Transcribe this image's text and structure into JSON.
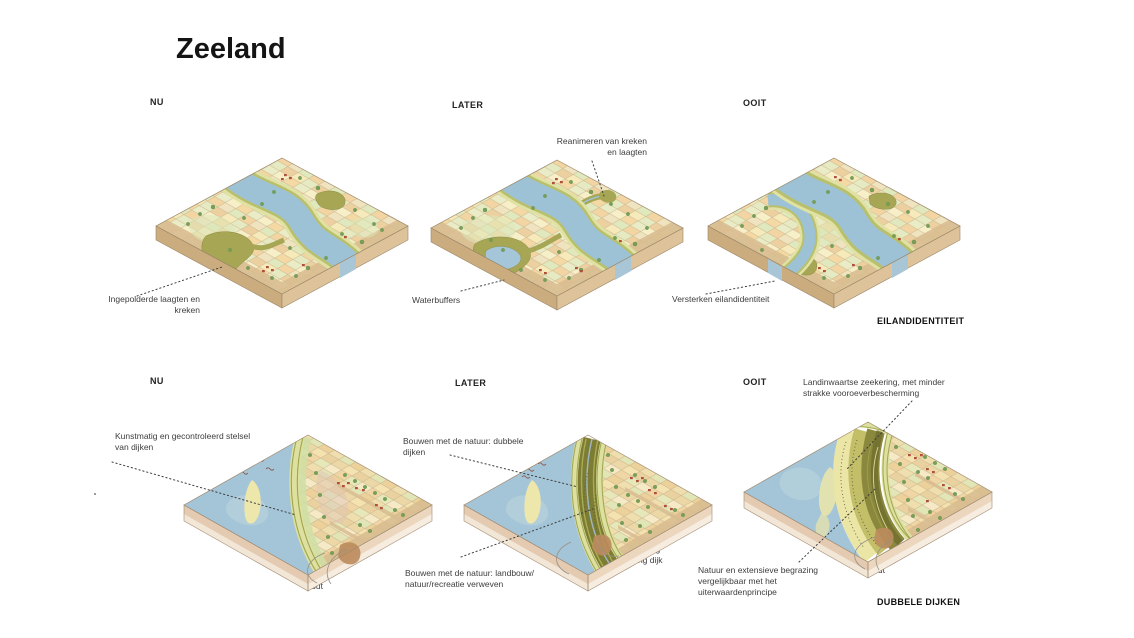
{
  "page": {
    "title": "Zeeland"
  },
  "row1": {
    "nu": "NU",
    "later": "LATER",
    "ooit": "OOIT",
    "category": "EILANDIDENTITEIT",
    "reanimeren_line1": "Reanimeren van kreken",
    "reanimeren_line2": "en laagten",
    "ingepolderde_line1": "Ingepolderde laagten en",
    "ingepolderde_line2": "kreken",
    "waterbuffers": "Waterbuffers",
    "versterken": "Versterken eilandidentiteit"
  },
  "row2": {
    "nu": "NU",
    "later": "LATER",
    "ooit": "OOIT",
    "category": "DUBBELE DIJKEN",
    "landinwaartse_line1": "Landinwaartse zeekering, met minder",
    "landinwaartse_line2": "strakke vooroeverbescherming",
    "kunstmatig_line1": "Kunstmatig en gecontroleerd stelsel",
    "kunstmatig_line2": "van dijken",
    "brak": "Brak",
    "bouwen_dubbele_line1": "Bouwen met de natuur: dubbele",
    "bouwen_dubbele_line2": "dijken",
    "bouwen_landbouw_line1": "Bouwen met de natuur: landbouw/",
    "bouwen_landbouw_line2": "natuur/recreatie verweven",
    "verlegging_line1": "Verlegging",
    "verlegging_line2": "richting dijk",
    "natuur_line1": "Natuur en extensieve begrazing",
    "natuur_line2": "vergelijkbaar met het",
    "natuur_line3": "uiterwaardenprincipe",
    "zout_nu": "Zout",
    "zout_later": "Zout",
    "zout_ooit": "Zout"
  },
  "colors": {
    "background": "#ffffff",
    "text": "#3d3d3d",
    "heading": "#141414",
    "water": "#9fc2d6",
    "sea": "#a4c5d7",
    "land_side": "#d3b48a",
    "coast_side": "#e3cab0",
    "field_cream": "#f1e4c2",
    "field_orange": "#f2d5a2",
    "field_green": "#dfe8bd",
    "creek_olive": "#a6a654",
    "dike_light": "#dde09e",
    "dike_stripe": "#a0a552",
    "marsh_dark": "#7d7c34",
    "sand": "#ece6a8",
    "house_red": "#b0503c",
    "tree_green": "#76a058",
    "seep_brown": "#bd8c5e"
  }
}
